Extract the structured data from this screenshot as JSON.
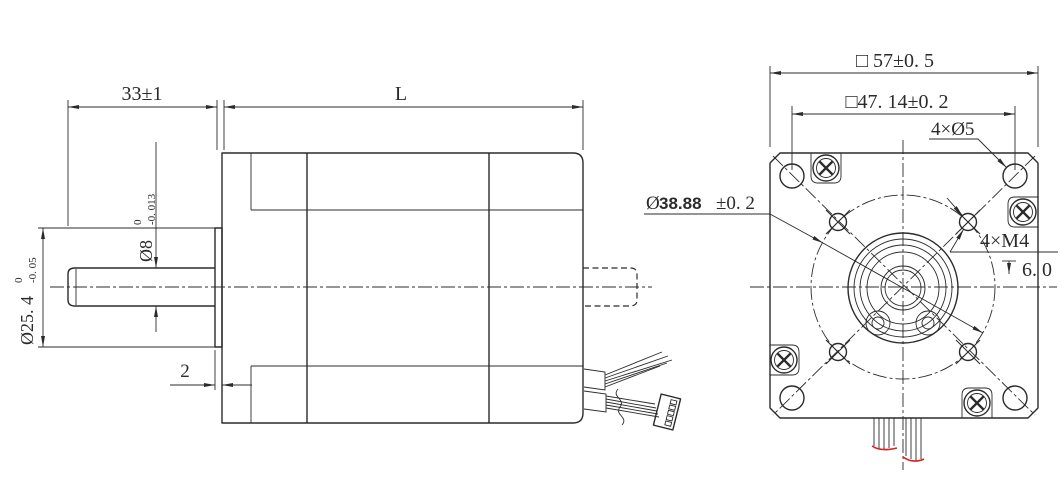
{
  "drawing": {
    "type": "engineering-dimension-drawing",
    "subject": "57 mm square-flange stepper motor outline drawing, side view and front (flange) view",
    "colors": {
      "line": "#2b2b2b",
      "wire_tip": "#d42020",
      "background": "#ffffff"
    },
    "side_view": {
      "dimensions": {
        "shaft_extension": "33±1",
        "body_length": "L",
        "shaft_diameter": {
          "text": "Ø8",
          "tol_upper": "0",
          "tol_lower": "-0. 013"
        },
        "pilot_boss_diameter": {
          "text": "Ø25. 4",
          "tol_upper": "0",
          "tol_lower": "-0. 05"
        },
        "boss_protrusion": "2"
      },
      "features": [
        "front shaft",
        "pilot boss",
        "motor body",
        "hidden rear shaft",
        "lead wire bundle",
        "5-pin connector"
      ]
    },
    "front_view": {
      "dimensions": {
        "frame_size": "□ 57±0. 5",
        "mounting_hole_spacing": "□47. 14±0. 2",
        "corner_holes": "4×Ø5",
        "bolt_circle_prefix": "Ø",
        "bolt_circle_value": "38.88",
        "bolt_circle_tol": "±0. 2",
        "tapped_holes": "4×M4",
        "tap_depth": "6. 0"
      },
      "features": [
        "square flange with chamfered corners",
        "4 corner through holes",
        "4 tapped M4 holes on bolt circle",
        "pilot boss concentric circles",
        "4 cross-recess case screws",
        "lead wires with red ends"
      ]
    }
  }
}
